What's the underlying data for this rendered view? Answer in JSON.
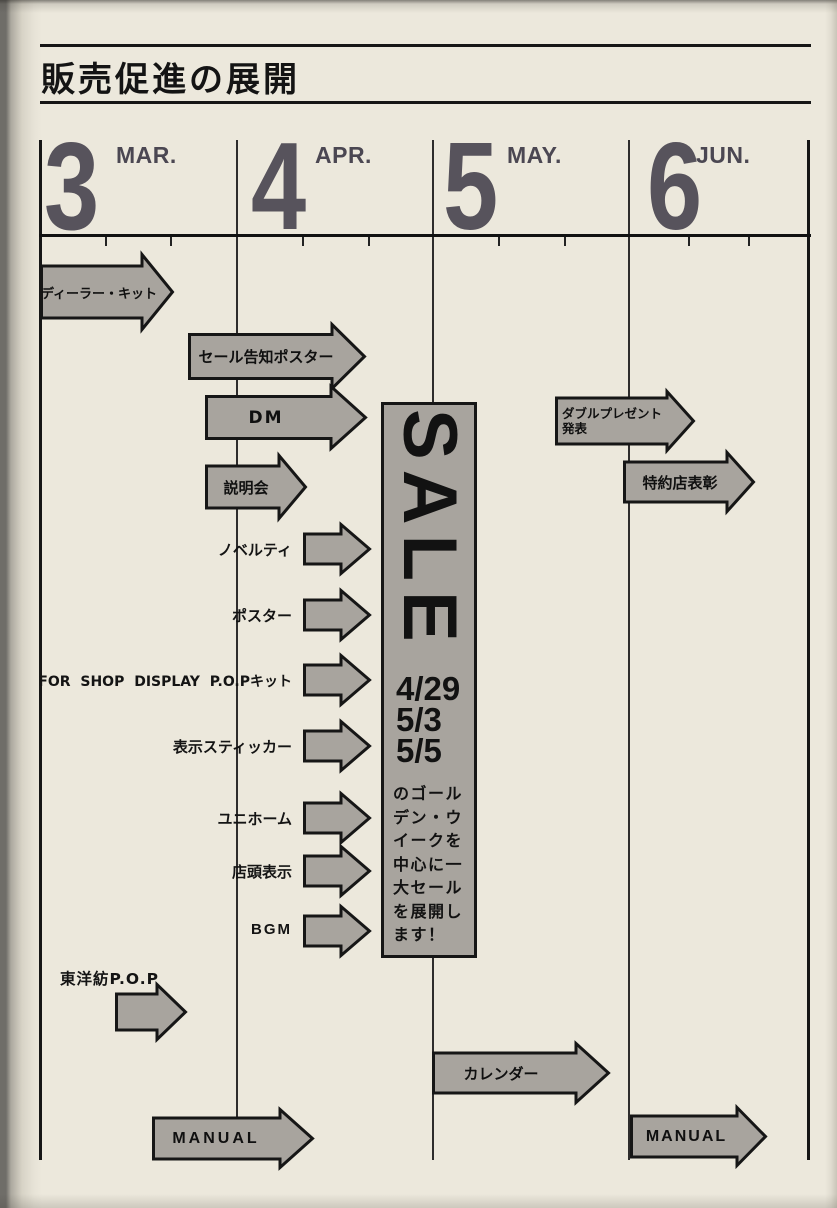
{
  "colors": {
    "paper": "#ece8dc",
    "ink": "#1c1c1c",
    "numeral": "#57535c",
    "arrow_fill": "#a8a49e",
    "arrow_stroke": "#161616"
  },
  "title": "販売促進の展開",
  "months": [
    {
      "number": "3",
      "abbr": "MAR."
    },
    {
      "number": "4",
      "abbr": "APR."
    },
    {
      "number": "5",
      "abbr": "MAY."
    },
    {
      "number": "6",
      "abbr": "JUN."
    }
  ],
  "arrows": {
    "dealer_kit": {
      "label": "ディーラー・キット"
    },
    "sale_poster": {
      "label": "セール告知ポスター"
    },
    "dm": {
      "label": "DM"
    },
    "briefing": {
      "label": "説明会"
    },
    "double_present": {
      "label_line1": "ダブルプレゼント",
      "label_line2": "発表"
    },
    "dealer_award": {
      "label": "特約店表彰"
    },
    "calendar": {
      "label": "カレンダー"
    },
    "manual_left": {
      "label": "MANUAL"
    },
    "manual_right": {
      "label": "MANUAL"
    }
  },
  "side_labels": [
    "ノベルティ",
    "ポスター",
    "FOR SHOP DISPLAY P.O.Pキット",
    "表示スティッカー",
    "ユニホーム",
    "店頭表示",
    "BGM"
  ],
  "toyobo_label": "東洋紡P.O.P",
  "sale": {
    "word": "SALE",
    "dates": [
      "4/29",
      "5/3",
      "5/5"
    ],
    "message": "のゴールデン・ウイークを中心に一大セールを展開します！"
  }
}
